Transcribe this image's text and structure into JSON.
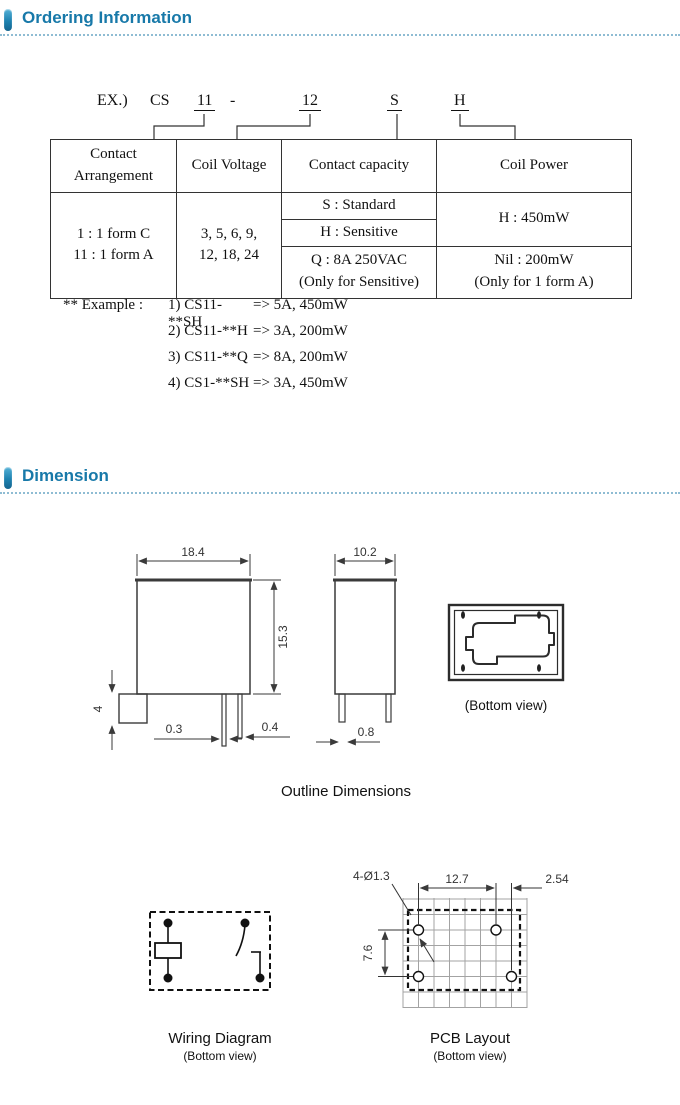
{
  "ordering_section": {
    "title": "Ordering Information"
  },
  "dimension_section": {
    "title": "Dimension"
  },
  "code": {
    "prefix": "EX.)",
    "series": "CS",
    "arrangement": "11",
    "dash": "-",
    "voltage": "12",
    "capacity": "S",
    "power": "H"
  },
  "table": {
    "headers": {
      "arrangement": "Contact Arrangement",
      "voltage": "Coil Voltage",
      "capacity": "Contact capacity",
      "power": "Coil Power"
    },
    "arrangement_line1": "1 : 1 form C",
    "arrangement_line2": "11 : 1 form A",
    "voltage_line1": "3, 5, 6, 9,",
    "voltage_line2": "12, 18, 24",
    "capacity_s": "S : Standard",
    "capacity_h": "H : Sensitive",
    "capacity_q": "Q : 8A 250VAC",
    "capacity_q_note": "(Only for Sensitive)",
    "power_h": "H : 450mW",
    "power_nil": "Nil : 200mW",
    "power_nil_note": "(Only for 1 form A)"
  },
  "examples": {
    "prefix": "** Example :",
    "items": [
      {
        "code": "1) CS11-**SH",
        "result": "=> 5A, 450mW"
      },
      {
        "code": "2) CS11-**H",
        "result": "=> 3A, 200mW"
      },
      {
        "code": "3) CS11-**Q",
        "result": "=> 8A, 200mW"
      },
      {
        "code": "4) CS1-**SH",
        "result": "=> 3A, 450mW"
      }
    ]
  },
  "outline": {
    "front_width": "18.4",
    "front_height": "15.3",
    "pin_length": "4",
    "pin_w1": "0.3",
    "pin_w2": "0.4",
    "side_width": "10.2",
    "side_pin_w": "0.8",
    "bottom_view_label": "(Bottom view)",
    "caption": "Outline Dimensions"
  },
  "wiring": {
    "caption": "Wiring Diagram",
    "sub": "(Bottom view)"
  },
  "pcb": {
    "holes": "4-Ø1.3",
    "dim_x": "12.7",
    "dim_pitch": "2.54",
    "dim_y": "7.6",
    "caption": "PCB Layout",
    "sub": "(Bottom view)"
  }
}
